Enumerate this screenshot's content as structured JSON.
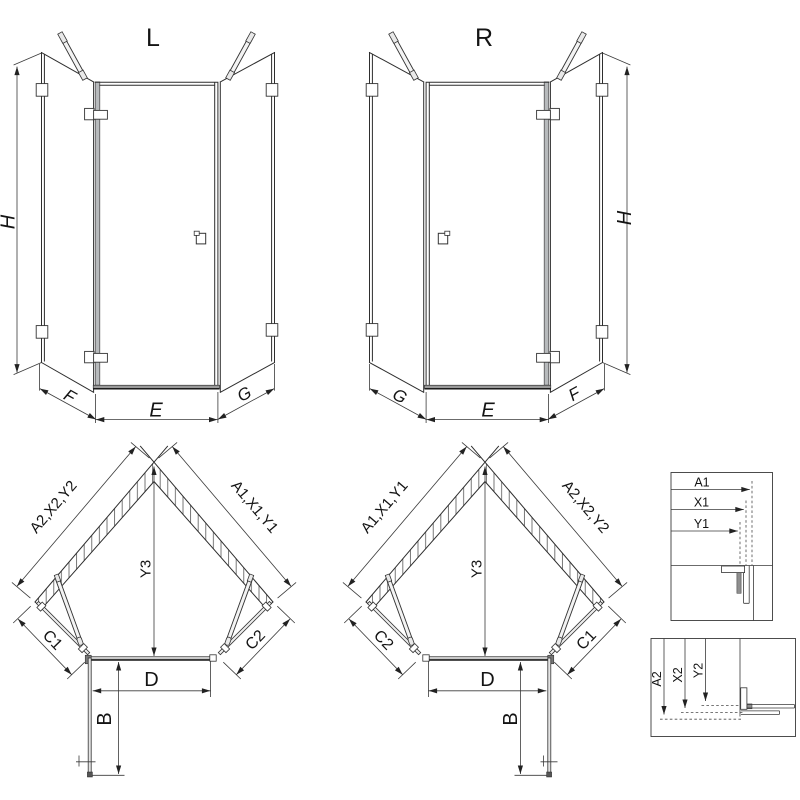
{
  "drawing": {
    "type": "shower-enclosure-technical-drawing",
    "views": {
      "front_left": {
        "title": "L",
        "height_label": "H",
        "left_panel_label": "F",
        "door_label": "E",
        "right_panel_label": "G"
      },
      "front_right": {
        "title": "R",
        "height_label": "H",
        "left_panel_label": "G",
        "door_label": "E",
        "right_panel_label": "F"
      },
      "plan_left": {
        "left_wall_label": "A2,X2,Y2",
        "right_wall_label": "A1,X1,Y1",
        "depth_label": "Y3",
        "left_side_label": "C1",
        "right_side_label": "C2",
        "door_width_label": "D",
        "door_swing_label": "B"
      },
      "plan_right": {
        "left_wall_label": "A1,X1,Y1",
        "right_wall_label": "A2,X2,Y2",
        "depth_label": "Y3",
        "left_side_label": "C2",
        "right_side_label": "C1",
        "door_width_label": "D",
        "door_swing_label": "B"
      },
      "detail_top": {
        "labels": [
          "A1",
          "X1",
          "Y1"
        ]
      },
      "detail_bottom": {
        "labels": [
          "A2",
          "X2",
          "Y2"
        ]
      }
    },
    "colors": {
      "line": "#2e2e2e",
      "frame_gray": "#b7babc",
      "threshold_gray": "#9a9a9a",
      "hatch": "#555555",
      "background": "#ffffff",
      "text": "#141414"
    }
  }
}
